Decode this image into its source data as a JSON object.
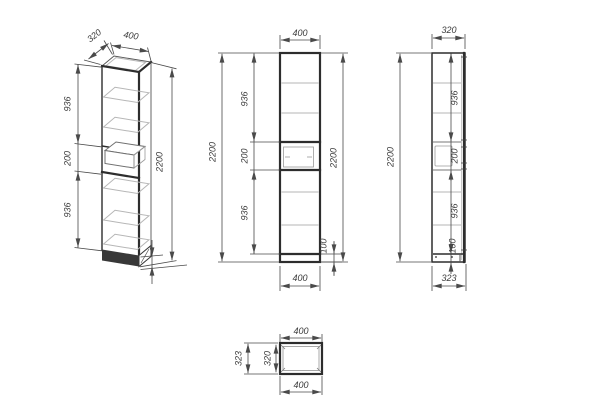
{
  "drawing": {
    "type": "cabinet-orthographic-technical-drawing",
    "views": {
      "isometric": {
        "dims": {
          "depth_top": "320",
          "width_top": "400",
          "upper_section": "936",
          "niche": "200",
          "lower_section": "936",
          "total_height": "2200"
        }
      },
      "front": {
        "dims": {
          "width_top": "400",
          "height_left": "2200",
          "upper_section": "936",
          "niche": "200",
          "lower_section": "936",
          "height_right": "2200",
          "plinth": "100",
          "width_bottom": "400"
        }
      },
      "side": {
        "dims": {
          "depth_top": "320",
          "height": "2200",
          "upper_section": "936",
          "niche": "200",
          "lower_section": "936",
          "plinth": "100",
          "depth_bottom": "323"
        }
      },
      "top": {
        "dims": {
          "width_top": "400",
          "depth_inner": "320",
          "depth_outer": "323",
          "width_bottom": "400"
        }
      }
    },
    "colors": {
      "object_line": "#2d2d2d",
      "shelf_line": "#b6b6b6",
      "dimension_line": "#4a4a4a",
      "text": "#3c3c3c",
      "background": "#ffffff"
    }
  }
}
